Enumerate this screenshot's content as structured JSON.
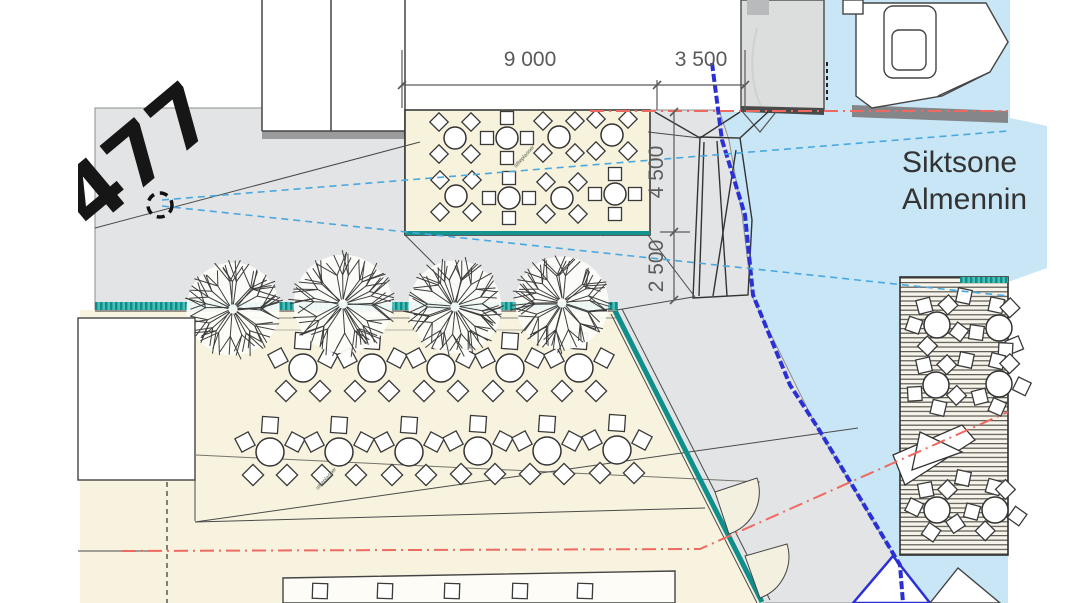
{
  "drawing": {
    "dimensions": {
      "top_width_main": "9 000",
      "top_width_side": "3 500",
      "vertical_upper": "4 500",
      "vertical_lower": "2 500"
    },
    "labels": {
      "sight_zone_line1": "Siktsone",
      "sight_zone_line2": "Almennin",
      "plot_number": "477",
      "tiny_annotation": "sitteplasser"
    },
    "colors": {
      "water": "#c8e6f5",
      "promenade": "#e3e4e5",
      "terrace": "#f7f3df",
      "platform": "#f6f2dc",
      "deck_background": "#f5f3ea",
      "teal_edge": "#13948f",
      "sight_line_blue": "#4aa8e0",
      "center_line_red": "#ee6a61",
      "quay_edge_blue": "#2b30d6",
      "linework": "#3a3a3a"
    },
    "furniture": {
      "platform_tables": [
        {
          "x": 455,
          "y": 138,
          "style": "diag"
        },
        {
          "x": 507,
          "y": 138,
          "style": "orth"
        },
        {
          "x": 559,
          "y": 137,
          "style": "diag"
        },
        {
          "x": 612,
          "y": 135,
          "style": "diag"
        },
        {
          "x": 456,
          "y": 196,
          "style": "diag"
        },
        {
          "x": 509,
          "y": 198,
          "style": "orth"
        },
        {
          "x": 562,
          "y": 198,
          "style": "diag"
        },
        {
          "x": 615,
          "y": 194,
          "style": "orth"
        }
      ],
      "terrace_tables": [
        {
          "x": 303,
          "y": 368,
          "style": "five"
        },
        {
          "x": 372,
          "y": 368,
          "style": "five"
        },
        {
          "x": 441,
          "y": 368,
          "style": "five"
        },
        {
          "x": 510,
          "y": 368,
          "style": "five"
        },
        {
          "x": 579,
          "y": 368,
          "style": "five"
        },
        {
          "x": 270,
          "y": 452,
          "style": "five"
        },
        {
          "x": 339,
          "y": 452,
          "style": "five"
        },
        {
          "x": 409,
          "y": 452,
          "style": "five"
        },
        {
          "x": 478,
          "y": 451,
          "style": "five"
        },
        {
          "x": 547,
          "y": 451,
          "style": "five"
        },
        {
          "x": 617,
          "y": 450,
          "style": "five"
        }
      ],
      "deck_tables": [
        {
          "x": 937,
          "y": 325,
          "style": "deck"
        },
        {
          "x": 999,
          "y": 328,
          "style": "deck"
        },
        {
          "x": 936,
          "y": 385,
          "style": "deck"
        },
        {
          "x": 999,
          "y": 384,
          "style": "deck"
        },
        {
          "x": 937,
          "y": 510,
          "style": "deck"
        },
        {
          "x": 995,
          "y": 510,
          "style": "deck"
        }
      ],
      "deck_single_chairs": [
        [
          964,
          296
        ],
        [
          966,
          360
        ],
        [
          963,
          478
        ]
      ],
      "bottom_row_chairs": [
        320,
        385,
        452,
        520,
        585
      ]
    },
    "trees": [
      {
        "x": 233,
        "y": 309,
        "r": 50
      },
      {
        "x": 343,
        "y": 304,
        "r": 53
      },
      {
        "x": 455,
        "y": 307,
        "r": 50
      },
      {
        "x": 562,
        "y": 303,
        "r": 50
      }
    ]
  }
}
